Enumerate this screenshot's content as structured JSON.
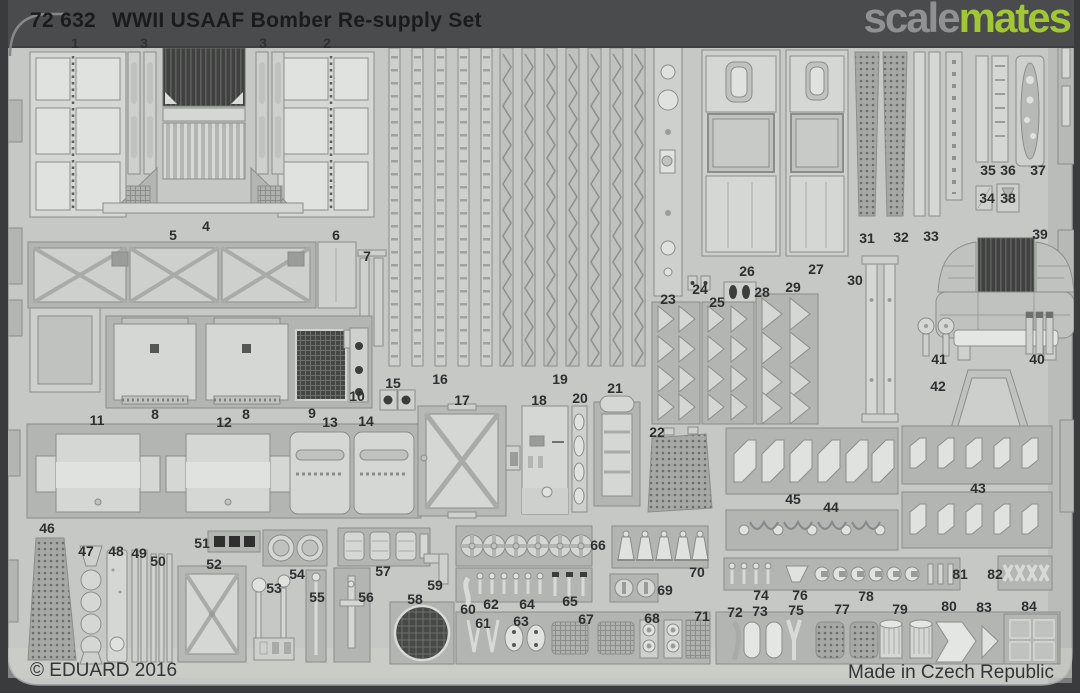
{
  "header": {
    "catalog_number": "72 632",
    "product_title": "WWII USAAF Bomber Re-supply Set"
  },
  "watermark": {
    "brand_part_gray": "scale",
    "brand_part_green": "mates"
  },
  "footer": {
    "copyright": "© EDUARD 2016",
    "made_in": "Made in Czech Republic"
  },
  "colors": {
    "background": "#3b3c3e",
    "top_bar": "#4a4b4d",
    "sheet": "#c6c8c5",
    "carrier": "#b3b5b2",
    "part_light": "#d5d7d4",
    "dark_mesh": "#454745",
    "brand_gray": "#8f9193",
    "brand_green": "#a3c636",
    "label_text": "#2e2f31"
  },
  "part_labels": [
    {
      "n": "1",
      "x": 75,
      "y": 43
    },
    {
      "n": "3",
      "x": 144,
      "y": 43
    },
    {
      "n": "3",
      "x": 263,
      "y": 43
    },
    {
      "n": "2",
      "x": 327,
      "y": 43
    },
    {
      "n": "4",
      "x": 206,
      "y": 226
    },
    {
      "n": "5",
      "x": 173,
      "y": 235
    },
    {
      "n": "6",
      "x": 336,
      "y": 235
    },
    {
      "n": "7",
      "x": 367,
      "y": 256
    },
    {
      "n": "8",
      "x": 155,
      "y": 414
    },
    {
      "n": "8",
      "x": 246,
      "y": 414
    },
    {
      "n": "9",
      "x": 312,
      "y": 413
    },
    {
      "n": "10",
      "x": 357,
      "y": 396
    },
    {
      "n": "11",
      "x": 97,
      "y": 420
    },
    {
      "n": "12",
      "x": 224,
      "y": 422
    },
    {
      "n": "13",
      "x": 330,
      "y": 422
    },
    {
      "n": "14",
      "x": 366,
      "y": 421
    },
    {
      "n": "15",
      "x": 393,
      "y": 383
    },
    {
      "n": "16",
      "x": 440,
      "y": 379
    },
    {
      "n": "17",
      "x": 462,
      "y": 400
    },
    {
      "n": "18",
      "x": 539,
      "y": 400
    },
    {
      "n": "19",
      "x": 560,
      "y": 379
    },
    {
      "n": "20",
      "x": 580,
      "y": 398
    },
    {
      "n": "21",
      "x": 615,
      "y": 388
    },
    {
      "n": "22",
      "x": 657,
      "y": 432
    },
    {
      "n": "23",
      "x": 668,
      "y": 299
    },
    {
      "n": "24",
      "x": 700,
      "y": 289
    },
    {
      "n": "25",
      "x": 717,
      "y": 302
    },
    {
      "n": "26",
      "x": 747,
      "y": 271
    },
    {
      "n": "27",
      "x": 816,
      "y": 269
    },
    {
      "n": "28",
      "x": 762,
      "y": 292
    },
    {
      "n": "29",
      "x": 793,
      "y": 287
    },
    {
      "n": "30",
      "x": 855,
      "y": 280
    },
    {
      "n": "31",
      "x": 867,
      "y": 238
    },
    {
      "n": "32",
      "x": 901,
      "y": 237
    },
    {
      "n": "33",
      "x": 931,
      "y": 236
    },
    {
      "n": "34",
      "x": 987,
      "y": 198
    },
    {
      "n": "35",
      "x": 988,
      "y": 170
    },
    {
      "n": "36",
      "x": 1008,
      "y": 170
    },
    {
      "n": "37",
      "x": 1038,
      "y": 170
    },
    {
      "n": "38",
      "x": 1008,
      "y": 198
    },
    {
      "n": "39",
      "x": 1040,
      "y": 234
    },
    {
      "n": "40",
      "x": 1037,
      "y": 359
    },
    {
      "n": "41",
      "x": 939,
      "y": 359
    },
    {
      "n": "42",
      "x": 938,
      "y": 386
    },
    {
      "n": "43",
      "x": 978,
      "y": 488
    },
    {
      "n": "44",
      "x": 831,
      "y": 507
    },
    {
      "n": "45",
      "x": 793,
      "y": 499
    },
    {
      "n": "46",
      "x": 47,
      "y": 528
    },
    {
      "n": "47",
      "x": 86,
      "y": 551
    },
    {
      "n": "48",
      "x": 116,
      "y": 551
    },
    {
      "n": "49",
      "x": 139,
      "y": 553
    },
    {
      "n": "50",
      "x": 158,
      "y": 561
    },
    {
      "n": "51",
      "x": 202,
      "y": 543
    },
    {
      "n": "52",
      "x": 214,
      "y": 564
    },
    {
      "n": "53",
      "x": 274,
      "y": 588
    },
    {
      "n": "54",
      "x": 297,
      "y": 574
    },
    {
      "n": "55",
      "x": 317,
      "y": 597
    },
    {
      "n": "56",
      "x": 366,
      "y": 597
    },
    {
      "n": "57",
      "x": 383,
      "y": 571
    },
    {
      "n": "58",
      "x": 415,
      "y": 599
    },
    {
      "n": "59",
      "x": 435,
      "y": 585
    },
    {
      "n": "60",
      "x": 468,
      "y": 609
    },
    {
      "n": "61",
      "x": 483,
      "y": 623
    },
    {
      "n": "62",
      "x": 491,
      "y": 604
    },
    {
      "n": "63",
      "x": 521,
      "y": 621
    },
    {
      "n": "64",
      "x": 527,
      "y": 604
    },
    {
      "n": "65",
      "x": 570,
      "y": 601
    },
    {
      "n": "66",
      "x": 598,
      "y": 545
    },
    {
      "n": "67",
      "x": 586,
      "y": 619
    },
    {
      "n": "68",
      "x": 652,
      "y": 618
    },
    {
      "n": "69",
      "x": 665,
      "y": 590
    },
    {
      "n": "70",
      "x": 697,
      "y": 572
    },
    {
      "n": "71",
      "x": 702,
      "y": 616
    },
    {
      "n": "72",
      "x": 735,
      "y": 612
    },
    {
      "n": "73",
      "x": 760,
      "y": 611
    },
    {
      "n": "74",
      "x": 761,
      "y": 595
    },
    {
      "n": "75",
      "x": 796,
      "y": 610
    },
    {
      "n": "76",
      "x": 800,
      "y": 595
    },
    {
      "n": "77",
      "x": 842,
      "y": 609
    },
    {
      "n": "78",
      "x": 866,
      "y": 596
    },
    {
      "n": "79",
      "x": 900,
      "y": 609
    },
    {
      "n": "80",
      "x": 949,
      "y": 606
    },
    {
      "n": "81",
      "x": 960,
      "y": 574
    },
    {
      "n": "82",
      "x": 995,
      "y": 574
    },
    {
      "n": "83",
      "x": 984,
      "y": 607
    },
    {
      "n": "84",
      "x": 1029,
      "y": 606
    }
  ]
}
